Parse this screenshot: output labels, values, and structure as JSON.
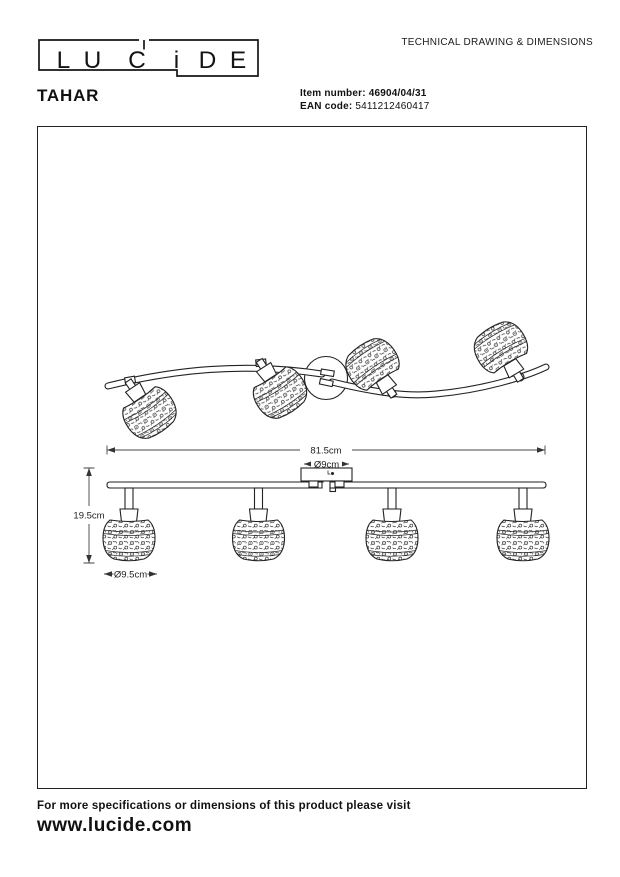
{
  "header": {
    "logo": {
      "letters": [
        "L",
        "U",
        "C",
        "i",
        "D",
        "E"
      ]
    },
    "doc_title": "TECHNICAL DRAWING & DIMENSIONS",
    "product_name": "TAHAR",
    "item": {
      "label": "Item number:",
      "value": "46904/04/31"
    },
    "ean": {
      "label": "EAN code:",
      "value": "5411212460417"
    }
  },
  "drawing": {
    "dims": {
      "bar_length": "81.5cm",
      "canopy_diameter": "Ø9cm",
      "height": "19.5cm",
      "shade_diameter": "Ø9.5cm"
    }
  },
  "footer": {
    "note": "For more specifications or dimensions of this product please visit",
    "url": "www.lucide.com"
  }
}
